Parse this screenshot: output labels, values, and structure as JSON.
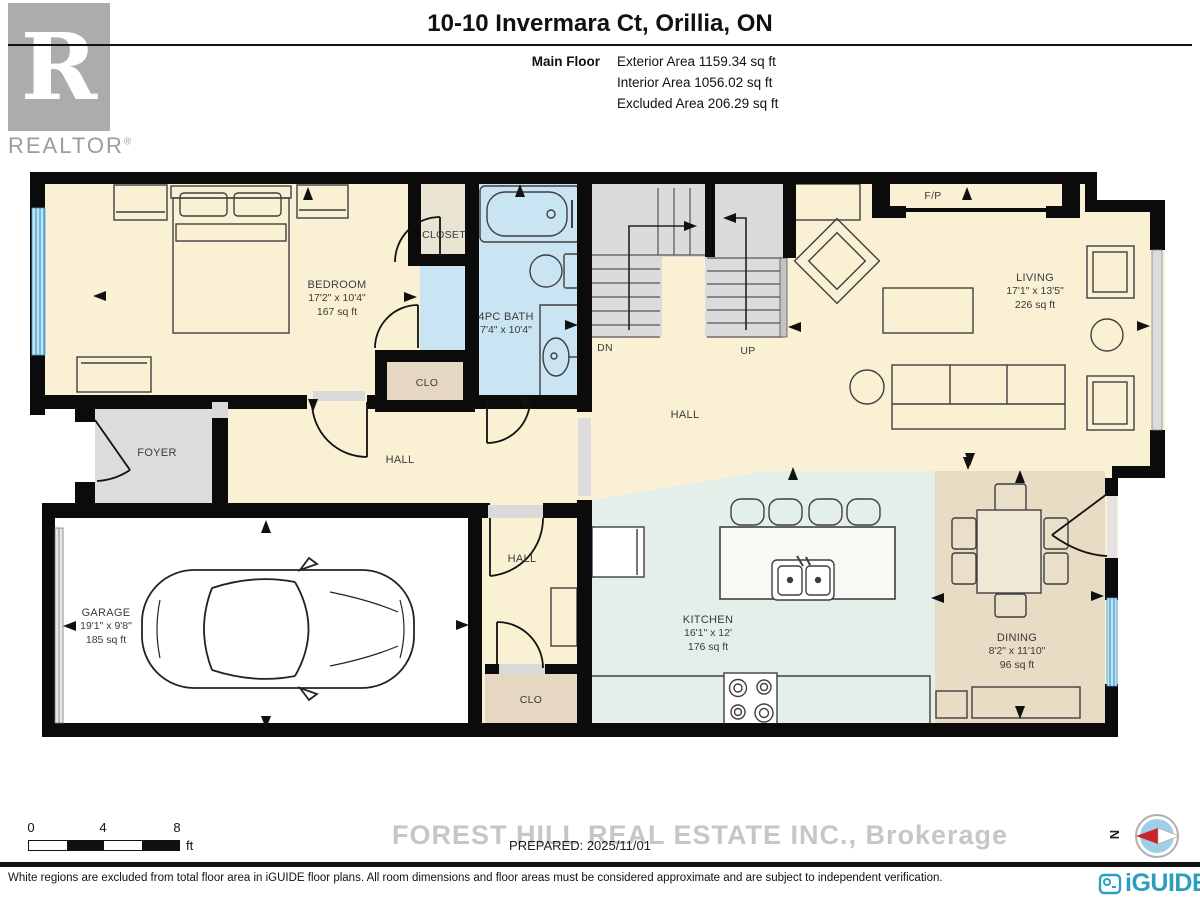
{
  "header": {
    "title": "10-10 Invermara Ct, Orillia, ON",
    "floor_label": "Main Floor",
    "area_lines": [
      "Exterior Area 1159.34 sq ft",
      "Interior Area 1056.02 sq ft",
      "Excluded Area 206.29 sq ft"
    ],
    "logo": {
      "letter": "R",
      "text": "REALTOR",
      "reg": "®"
    }
  },
  "rooms": {
    "bedroom": {
      "name": "BEDROOM",
      "dim": "17'2\" x 10'4\"",
      "area": "167 sq ft"
    },
    "closet": {
      "name": "CLOSET"
    },
    "bath": {
      "name": "4PC BATH",
      "dim": "7'4\" x 10'4\""
    },
    "clo_upper": {
      "name": "CLO"
    },
    "foyer": {
      "name": "FOYER"
    },
    "hall_west": {
      "name": "HALL"
    },
    "hall_center": {
      "name": "HALL"
    },
    "hall_south": {
      "name": "HALL"
    },
    "clo_lower": {
      "name": "CLO"
    },
    "garage": {
      "name": "GARAGE",
      "dim": "19'1\" x 9'8\"",
      "area": "185 sq ft"
    },
    "kitchen": {
      "name": "KITCHEN",
      "dim": "16'1\" x 12'",
      "area": "176 sq ft"
    },
    "living": {
      "name": "LIVING",
      "dim": "17'1\" x 13'5\"",
      "area": "226 sq ft"
    },
    "dining": {
      "name": "DINING",
      "dim": "8'2\" x 11'10\"",
      "area": "96 sq ft"
    },
    "fireplace": {
      "name": "F/P"
    },
    "stairs": {
      "down": "DN",
      "up": "UP"
    }
  },
  "scale_bar": {
    "ticks": [
      "0",
      "4",
      "8"
    ],
    "unit": "ft"
  },
  "footer": {
    "watermark": "FOREST HILL REAL ESTATE INC., Brokerage",
    "prepared": "PREPARED: 2025/11/01",
    "compass_north": "N",
    "disclaimer": "White regions are excluded from total floor area in iGUIDE floor plans. All room dimensions and floor areas must be considered approximate and are subject to independent verification.",
    "brand": "iGUIDE"
  },
  "colors": {
    "cream": "#FAF1D5",
    "bath_blue": "#C9E5F4",
    "kitchen_green": "#E4EFE9",
    "dining_tan": "#E8DCC5",
    "clo_tan": "#E6D7C3",
    "closet_beige": "#EAE4D3",
    "gray_room": "#DCDCDC",
    "window_blue": "#BFE3F5",
    "wall_black": "#0B0B0B",
    "brand_teal": "#2D9FBE",
    "compass_red": "#CC2229"
  }
}
